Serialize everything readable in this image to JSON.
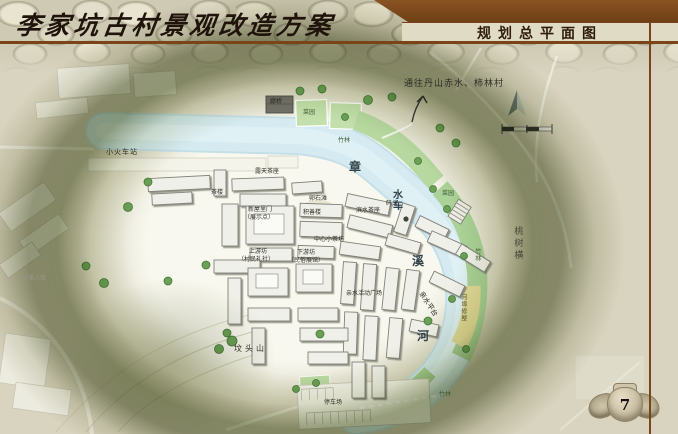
{
  "slide": {
    "title": "李家坑古村景观改造方案",
    "header_right": "规划总平面图",
    "page_number": "7"
  },
  "map": {
    "annotation": "通往丹山赤水、柿林村",
    "labels": [
      {
        "text": "菜园"
      },
      {
        "text": "竹林"
      },
      {
        "text": "廊桥"
      },
      {
        "text": "小火车站"
      },
      {
        "text": "章"
      },
      {
        "text": "水车"
      },
      {
        "text": "溪"
      },
      {
        "text": "河"
      },
      {
        "text": "菜园"
      },
      {
        "text": "桃树横"
      },
      {
        "text": "茶楼"
      },
      {
        "text": "露天茶座"
      },
      {
        "text": "卵石滩"
      },
      {
        "text": "滨水茶座"
      },
      {
        "text": "码头"
      },
      {
        "text": "新屋里门"
      },
      {
        "text": "（展示点）"
      },
      {
        "text": "积善楼"
      },
      {
        "text": "中心小茶坊"
      },
      {
        "text": "上游坊"
      },
      {
        "text": "（村民礼社）"
      },
      {
        "text": "下游坊"
      },
      {
        "text": "（民俗展馆）"
      },
      {
        "text": "亲水活动广场"
      },
      {
        "text": "亲水平台"
      },
      {
        "text": "河埠修整"
      },
      {
        "text": "竹林"
      },
      {
        "text": "坟头山"
      },
      {
        "text": "停车场"
      },
      {
        "text": "竹林"
      },
      {
        "text": "花溪人家"
      }
    ]
  },
  "colors": {
    "accent_brown": "#7a4418",
    "river_blue": "#d6ebf1",
    "vegetation_green": "#abd298",
    "field_yellow": "#e3db9b",
    "ring_olive": "#76804f",
    "stone_beige": "#d8d4bf"
  }
}
